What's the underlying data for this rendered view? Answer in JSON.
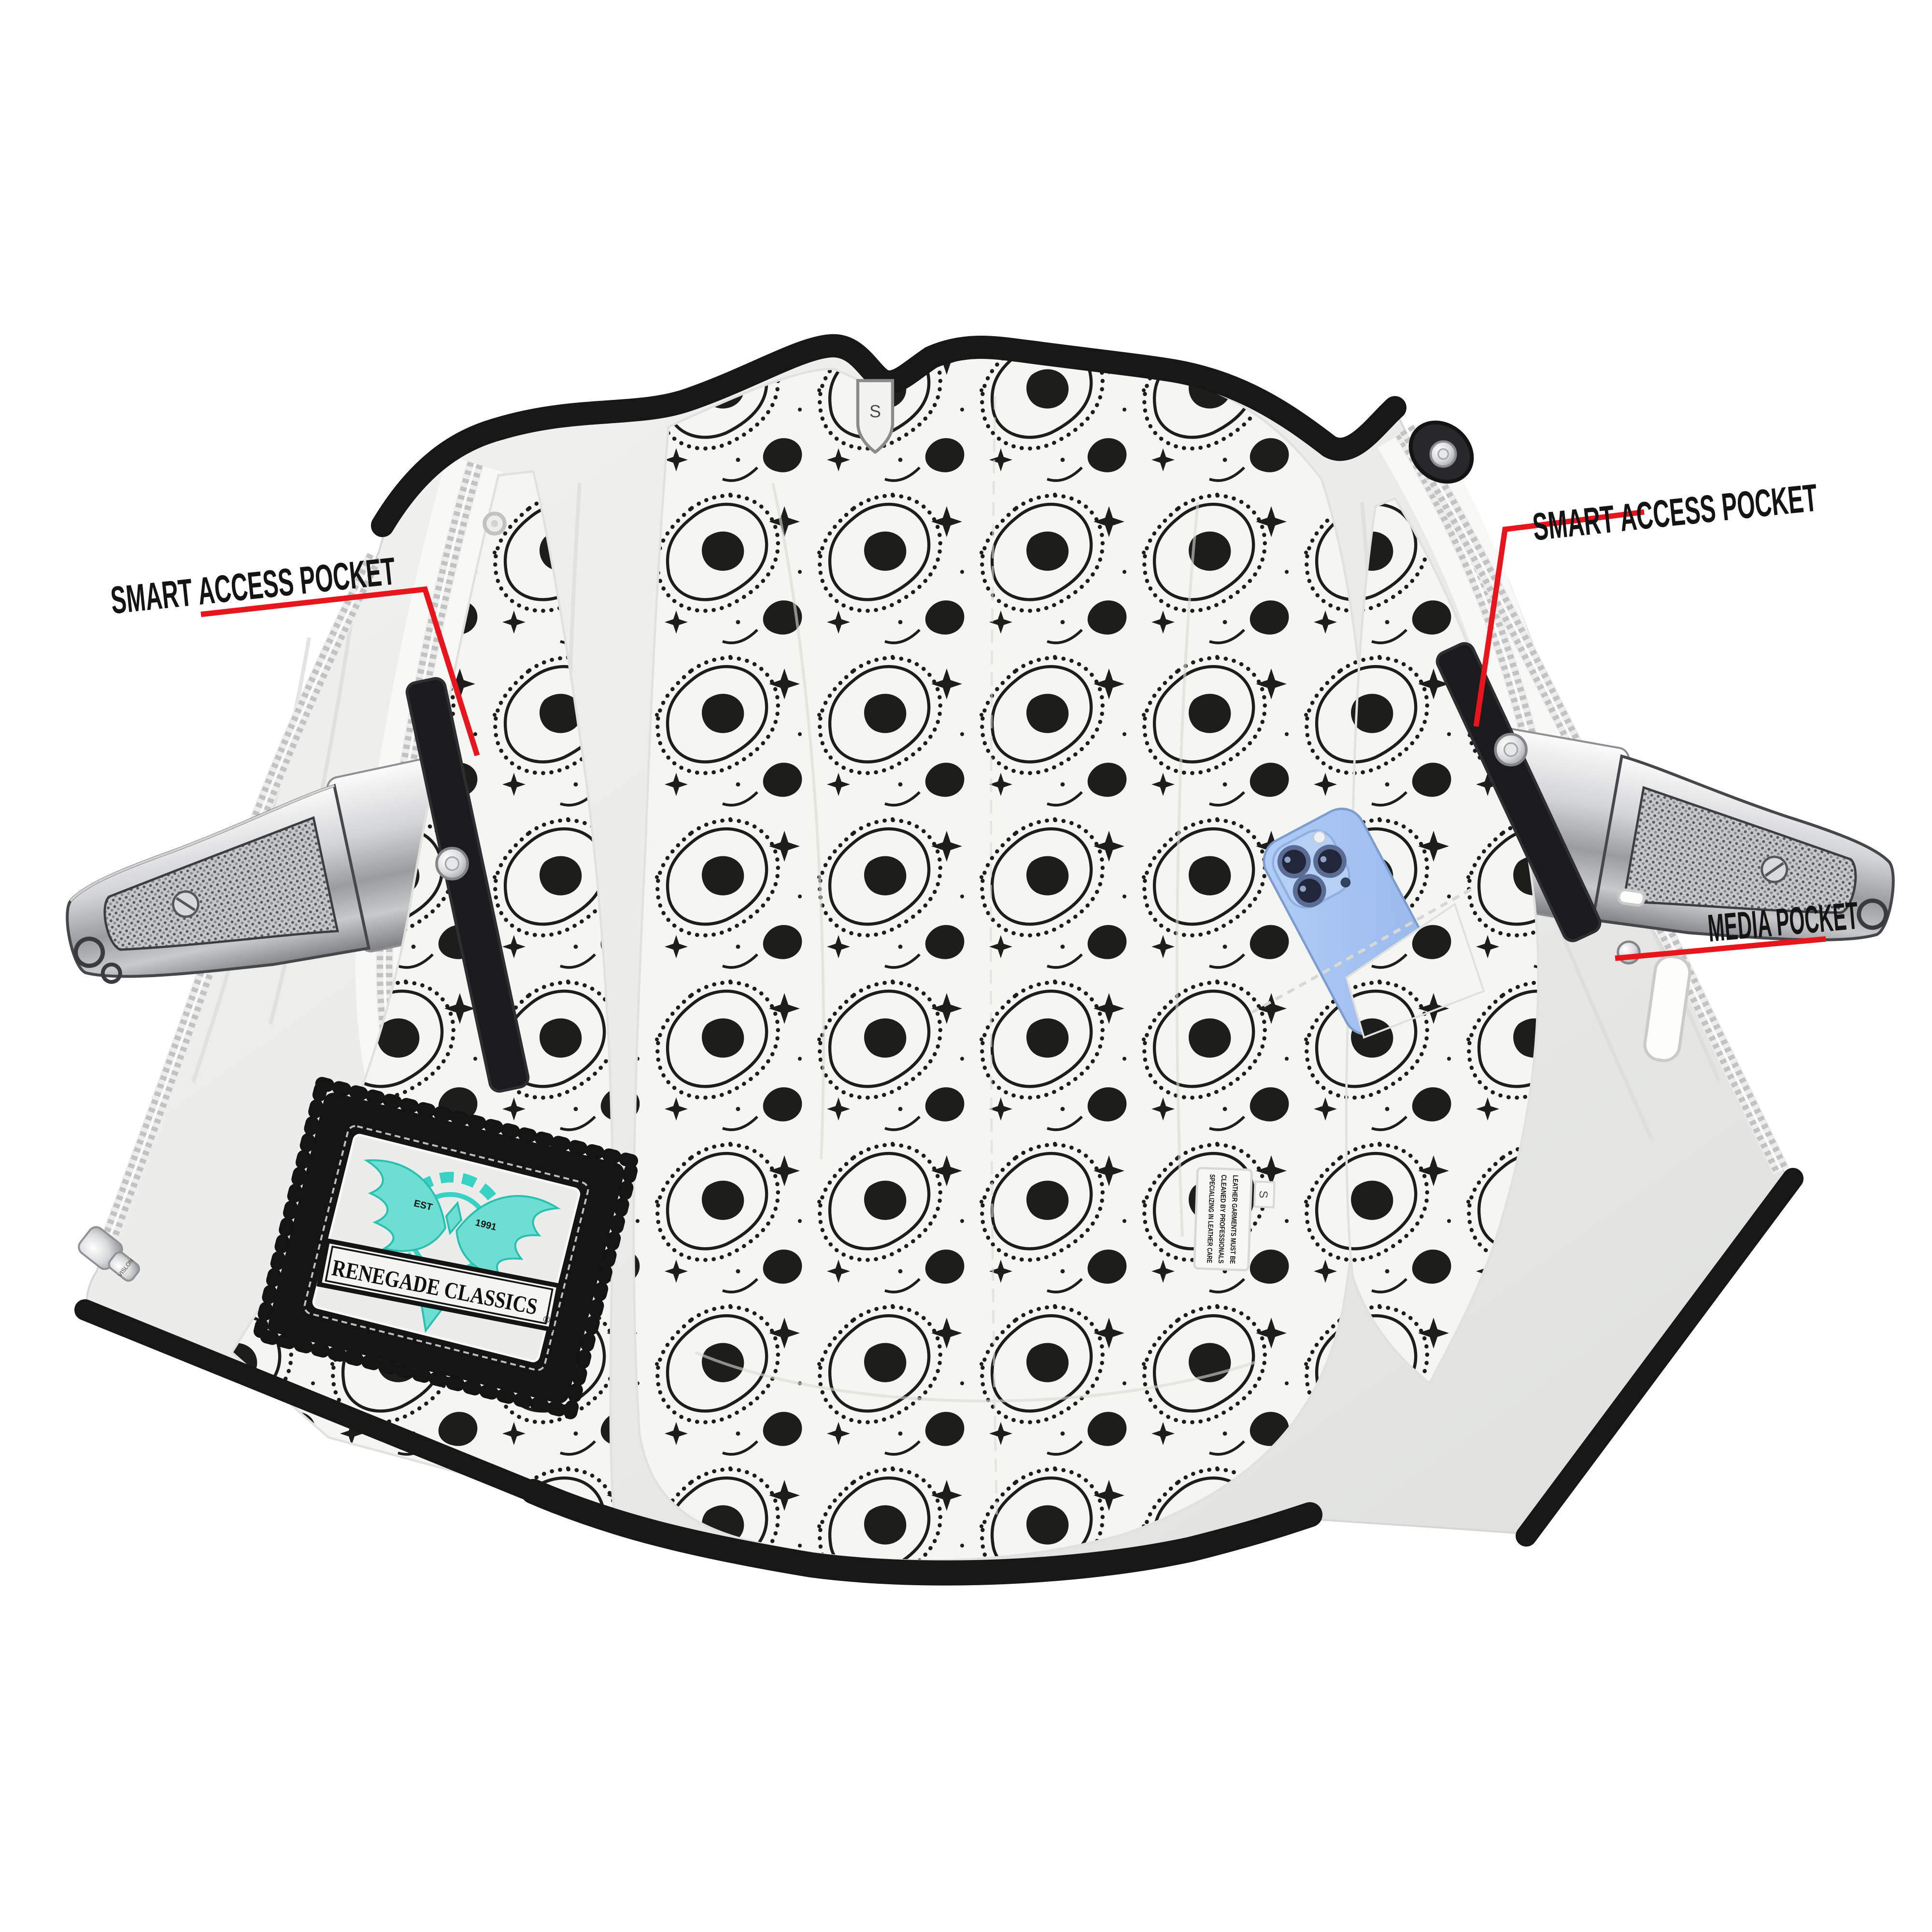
{
  "meta": {
    "subject": "Leather club vest interior with black-and-white paisley bandana lining, dual concealed-carry pockets with pistols, snap straps and a smartphone media pocket"
  },
  "callouts": {
    "left_smart_access": {
      "label": "SMART ACCESS POCKET"
    },
    "right_smart_access": {
      "label": "SMART ACCESS POCKET"
    },
    "media_pocket": {
      "label": "MEDIA POCKET"
    }
  },
  "tags": {
    "size": "S",
    "care_size": "S",
    "care_line1": "LEATHER GARMENTS MUST BE",
    "care_line2": "CLEANED BY PROFESSIONALS",
    "care_line3": "SPECIALIZING IN LEATHER CARE"
  },
  "brand_patch": {
    "name": "RENEGADE CLASSICS",
    "reg": "®",
    "est_prefix": "EST",
    "est_year": "1991"
  },
  "zipper": {
    "pull_text": "VISLON"
  },
  "colors": {
    "callout_red": "#e8151c",
    "patch_teal": "#38d2c4",
    "phone_blue": "#a6c6f1",
    "trim_black": "#171717",
    "lining_ink": "#1d1d1b",
    "leather": "#ebecea"
  }
}
